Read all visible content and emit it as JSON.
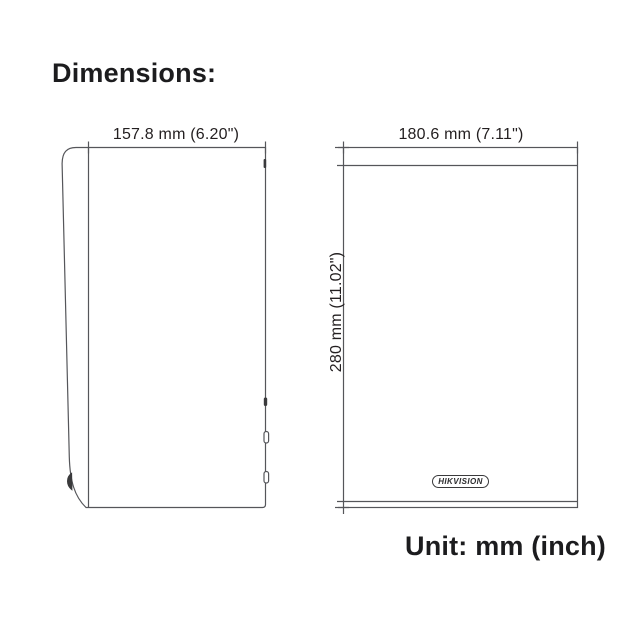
{
  "page": {
    "title": "Dimensions:",
    "unit_note": "Unit: mm (inch)"
  },
  "drawing": {
    "side_view": {
      "width_label": "157.8 mm (6.20\")"
    },
    "front_view": {
      "width_label": "180.6 mm (7.11\")",
      "height_label": "280 mm (11.02\")",
      "logo_text": "HIKVISION"
    },
    "colors": {
      "line": "#55565a",
      "label_text": "#231f20",
      "heading_text": "#1c1c1e",
      "background": "#ffffff"
    }
  }
}
